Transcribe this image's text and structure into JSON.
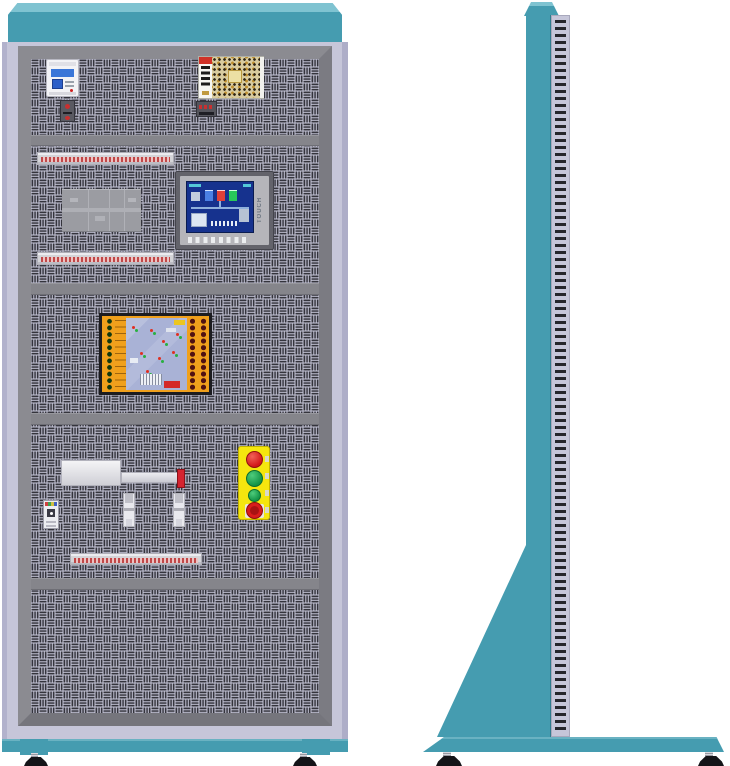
{
  "hmi": {
    "side_label": "TOUCH"
  },
  "colors": {
    "teal": "#459cb0",
    "teal_highlight": "#7fc3d1",
    "cabinet_body": "#c6c6d9",
    "frame_gray": "#85858b",
    "panel_base": "#c7c7da",
    "panel_slot": "#34343c",
    "breaker_blue": "#3a76d8",
    "terminal_strip_pink": "#ecc2c2",
    "terminal_dot_red": "#c04848",
    "relay_gray": "#9b9ca2",
    "hmi_screen_blue": "#16328e",
    "plc_orange": "#f0a01c",
    "plc_board_blue": "#a9b2d6",
    "button_panel_yellow": "#f5e60e",
    "button_red": "#d21818",
    "button_green": "#1ba04c",
    "emergency_stop_red": "#a81212",
    "actuator_tip_red": "#d42430",
    "foot_black": "#141418"
  },
  "views": {
    "front": {
      "components": [
        "circuit-breaker",
        "power-supply",
        "terminal-strips",
        "relay-block",
        "hmi-touch-panel",
        "plc-trainer-module",
        "linear-actuator",
        "proximity-sensors",
        "pcb-module",
        "push-button-station",
        "emergency-stop"
      ]
    },
    "side": {
      "components": [
        "top-cap",
        "cabinet-column",
        "mounting-rail",
        "support-gusset",
        "base-plate",
        "leveling-feet"
      ]
    }
  }
}
